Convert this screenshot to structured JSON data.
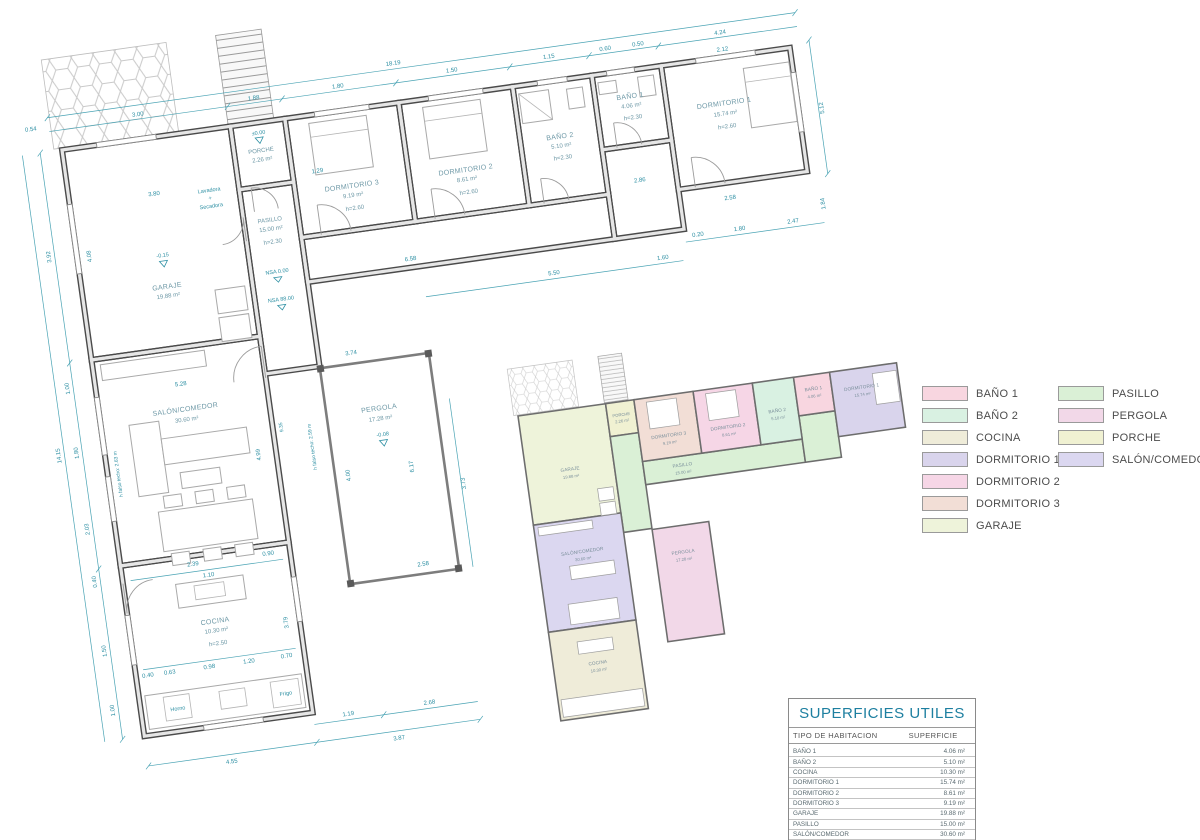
{
  "rooms": {
    "garaje": {
      "name": "GARAJE",
      "area": "19.88 m²"
    },
    "porche": {
      "name": "PORCHE",
      "area": "2.26 m²"
    },
    "dorm3": {
      "name": "DORMITORIO 3",
      "area": "9.19 m²",
      "h": "h=2.60"
    },
    "dorm2": {
      "name": "DORMITORIO 2",
      "area": "8.61 m²",
      "h": "h=2.60"
    },
    "bano2": {
      "name": "BAÑO 2",
      "area": "5.10 m²",
      "h": "h=2.30"
    },
    "bano1": {
      "name": "BAÑO 1",
      "area": "4.06 m²",
      "h": "h=2.30"
    },
    "dorm1": {
      "name": "DORMITORIO 1",
      "area": "15.74 m²",
      "h": "h=2.60"
    },
    "pasillo": {
      "name": "PASILLO",
      "area": "15.00 m²",
      "h": "h=2.30"
    },
    "salon": {
      "name": "SALÓN/COMEDOR",
      "area": "30.60 m²"
    },
    "cocina": {
      "name": "COCINA",
      "area": "10.30 m²",
      "h": "h=2.50"
    },
    "pergola": {
      "name": "PERGOLA",
      "area": "17.28 m²"
    }
  },
  "levels": {
    "garaje": "-0.15",
    "porche": "±0.00",
    "pergola": "-0.08",
    "nsa_a": "NSA 0.00",
    "nsa_b": "NSA 88.00"
  },
  "notes": {
    "falso_izq": "h falso techo: 2.63 m",
    "falso_der": "h falso techo: 2.59 m",
    "lavadora": "Lavadora",
    "mas": "+",
    "secadora": "Secadora",
    "horno": "Horno",
    "frigo": "Frigo"
  },
  "dims": {
    "top_total": "18.19",
    "top": [
      "0.54",
      "3.00",
      "1.88",
      "1.80",
      "1.50",
      "1.15",
      "0.60",
      "0.50",
      "4.24"
    ],
    "top_inner": "2.12",
    "left_total": "14.15",
    "left": [
      "3.92",
      "1.00",
      "1.80",
      "2.03",
      "0.40",
      "1.50",
      "1.00"
    ],
    "bottom": [
      "4.55",
      "3.87"
    ],
    "bottom_sub": [
      "1.19",
      "2.68"
    ],
    "right": [
      "5.12",
      "1.84",
      "2.47",
      "0.20",
      "1.80",
      "5.50",
      "1.60",
      "3.73"
    ],
    "inner": {
      "garage_w": "3.80",
      "garage_h": "4.08",
      "hall_w": "1.29",
      "salon_w": "5.28",
      "salon_h": "4.99",
      "mid_h": "9.35",
      "pasillo_l": "6.58",
      "hall2_w": "2.86",
      "dorm1_b": "2.58",
      "pergola_t": "3.74",
      "pergola_l": "4.00",
      "pergola_r": "6.17",
      "pergola_b": "2.58",
      "coc_a": "2.39",
      "coc_b": "0.90",
      "coc_c": "1.10",
      "coc_d": "0.63",
      "coc_e": "0.98",
      "coc_f": "1.20",
      "coc_g": "0.70",
      "coc_h": "3.79",
      "coc_i": "0.40"
    }
  },
  "legend": {
    "items": [
      {
        "label": "BAÑO 1",
        "color": "#f8d6e0"
      },
      {
        "label": "BAÑO 2",
        "color": "#d9f1e2"
      },
      {
        "label": "COCINA",
        "color": "#efecd9"
      },
      {
        "label": "DORMITORIO 1",
        "color": "#d9d4ec"
      },
      {
        "label": "DORMITORIO 2",
        "color": "#f6d6e6"
      },
      {
        "label": "DORMITORIO 3",
        "color": "#f2ded6"
      },
      {
        "label": "GARAJE",
        "color": "#eef3da"
      },
      {
        "label": "PASILLO",
        "color": "#daf0d6"
      },
      {
        "label": "PERGOLA",
        "color": "#f2d8e8"
      },
      {
        "label": "PORCHE",
        "color": "#f0f1d2"
      },
      {
        "label": "SALÓN/COMEDOR",
        "color": "#dbd7f0"
      }
    ]
  },
  "table": {
    "title": "SUPERFICIES UTILES",
    "col1": "TIPO DE HABITACION",
    "col2": "SUPERFICIE",
    "rows": [
      {
        "label": "BAÑO 1",
        "value": "4.06 m²"
      },
      {
        "label": "BAÑO 2",
        "value": "5.10 m²"
      },
      {
        "label": "COCINA",
        "value": "10.30 m²"
      },
      {
        "label": "DORMITORIO 1",
        "value": "15.74 m²"
      },
      {
        "label": "DORMITORIO 2",
        "value": "8.61 m²"
      },
      {
        "label": "DORMITORIO 3",
        "value": "9.19 m²"
      },
      {
        "label": "GARAJE",
        "value": "19.88 m²"
      },
      {
        "label": "PASILLO",
        "value": "15.00 m²"
      },
      {
        "label": "SALÓN/COMEDOR",
        "value": "30.60 m²"
      }
    ],
    "total": {
      "label": "Total general: 9",
      "value": "118.48 m²"
    }
  }
}
